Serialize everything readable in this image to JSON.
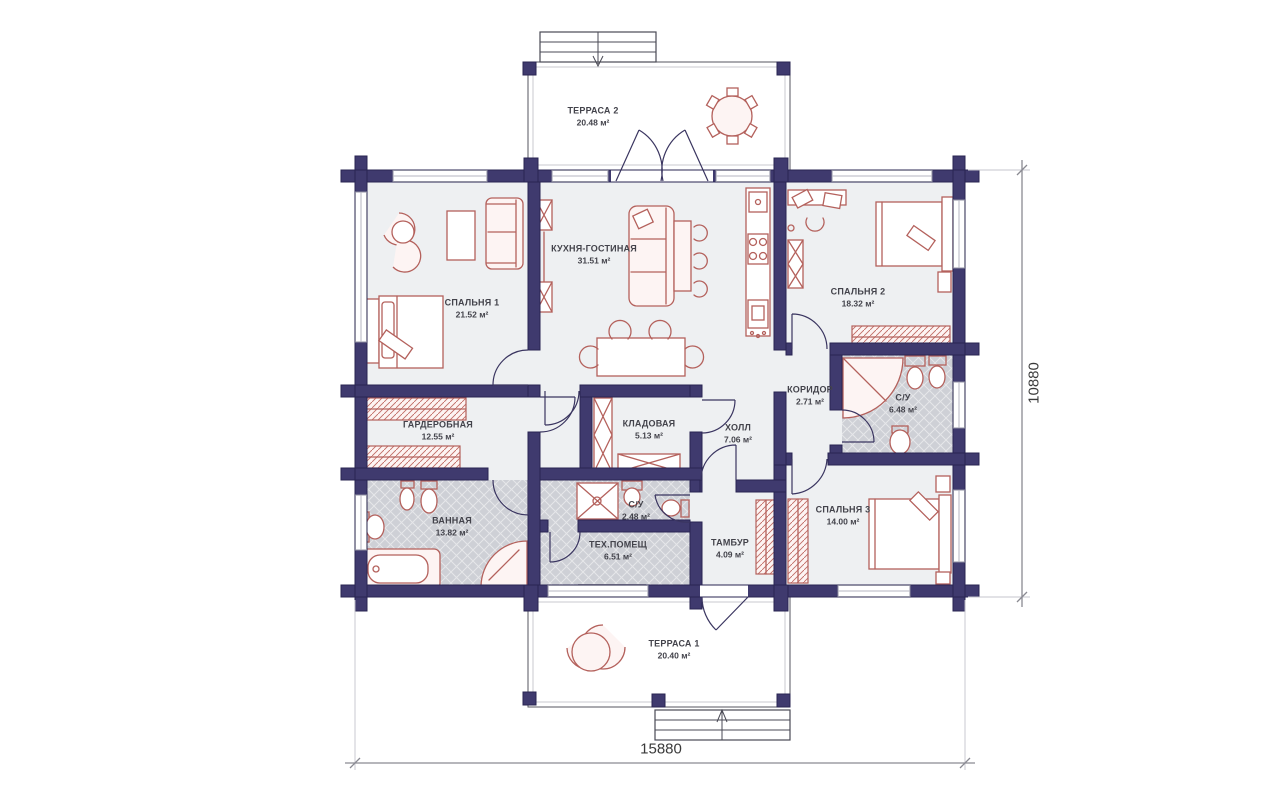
{
  "plan": {
    "rooms": [
      {
        "name": "ТЕРРАСА 2",
        "area": "20.48 м²"
      },
      {
        "name": "СПАЛЬНЯ 1",
        "area": "21.52 м²"
      },
      {
        "name": "КУХНЯ-ГОСТИНАЯ",
        "area": "31.51 м²"
      },
      {
        "name": "СПАЛЬНЯ 2",
        "area": "18.32 м²"
      },
      {
        "name": "КОРИДОР",
        "area": "2.71 м²"
      },
      {
        "name": "С/У",
        "area": "6.48 м²"
      },
      {
        "name": "ГАРДЕРОБНАЯ",
        "area": "12.55 м²"
      },
      {
        "name": "КЛАДОВАЯ",
        "area": "5.13 м²"
      },
      {
        "name": "ХОЛЛ",
        "area": "7.06 м²"
      },
      {
        "name": "ВАННАЯ",
        "area": "13.82 м²"
      },
      {
        "name": "С/У",
        "area": "2.48 м²"
      },
      {
        "name": "ТЕХ.ПОМЕЩ",
        "area": "6.51 м²"
      },
      {
        "name": "ТАМБУР",
        "area": "4.09 м²"
      },
      {
        "name": "СПАЛЬНЯ 3",
        "area": "14.00 м²"
      },
      {
        "name": "ТЕРРАСА 1",
        "area": "20.40 м²"
      }
    ],
    "dimensions": {
      "width": "15880",
      "height": "10880"
    },
    "colors": {
      "wall": "#3f3a6e",
      "furniture": "#b4615c",
      "floor": "#eef0f2",
      "wet_floor": "#ced0d6",
      "deck": "#f2f2f4"
    }
  }
}
